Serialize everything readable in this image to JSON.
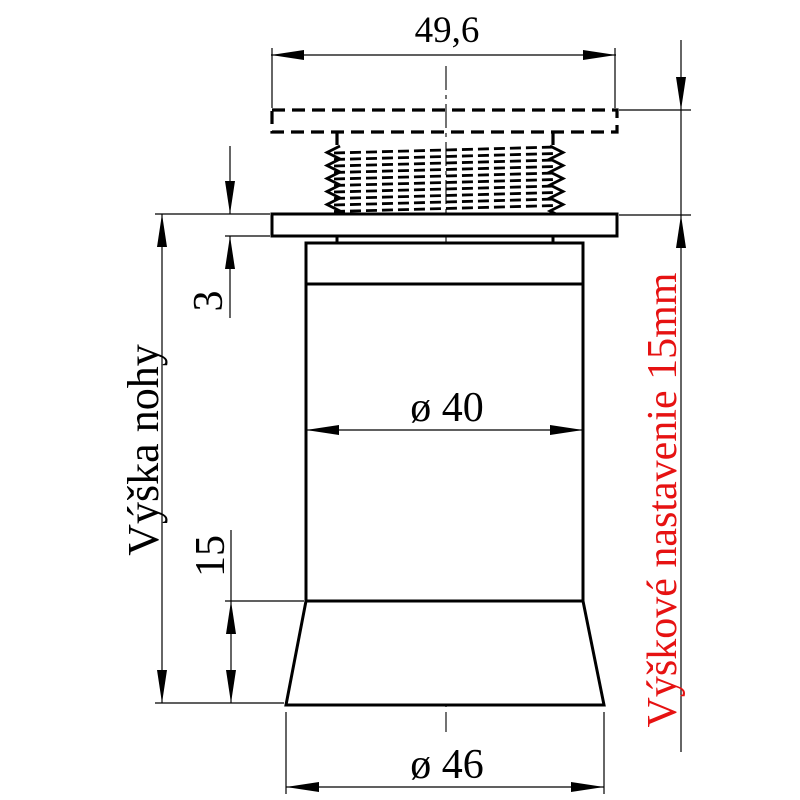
{
  "drawing": {
    "dimensions": {
      "top_plate_width": "49,6",
      "flange_thickness": "3",
      "base_cone_height": "15",
      "body_diameter": "ø 40",
      "base_diameter": "ø 46"
    },
    "labels": {
      "leg_height": "Výška nohy",
      "height_adjustment": "Výškové nastavenie 15mm"
    },
    "colors": {
      "line_color": "#000000",
      "accent_red": "#e61212",
      "background": "#ffffff"
    }
  }
}
